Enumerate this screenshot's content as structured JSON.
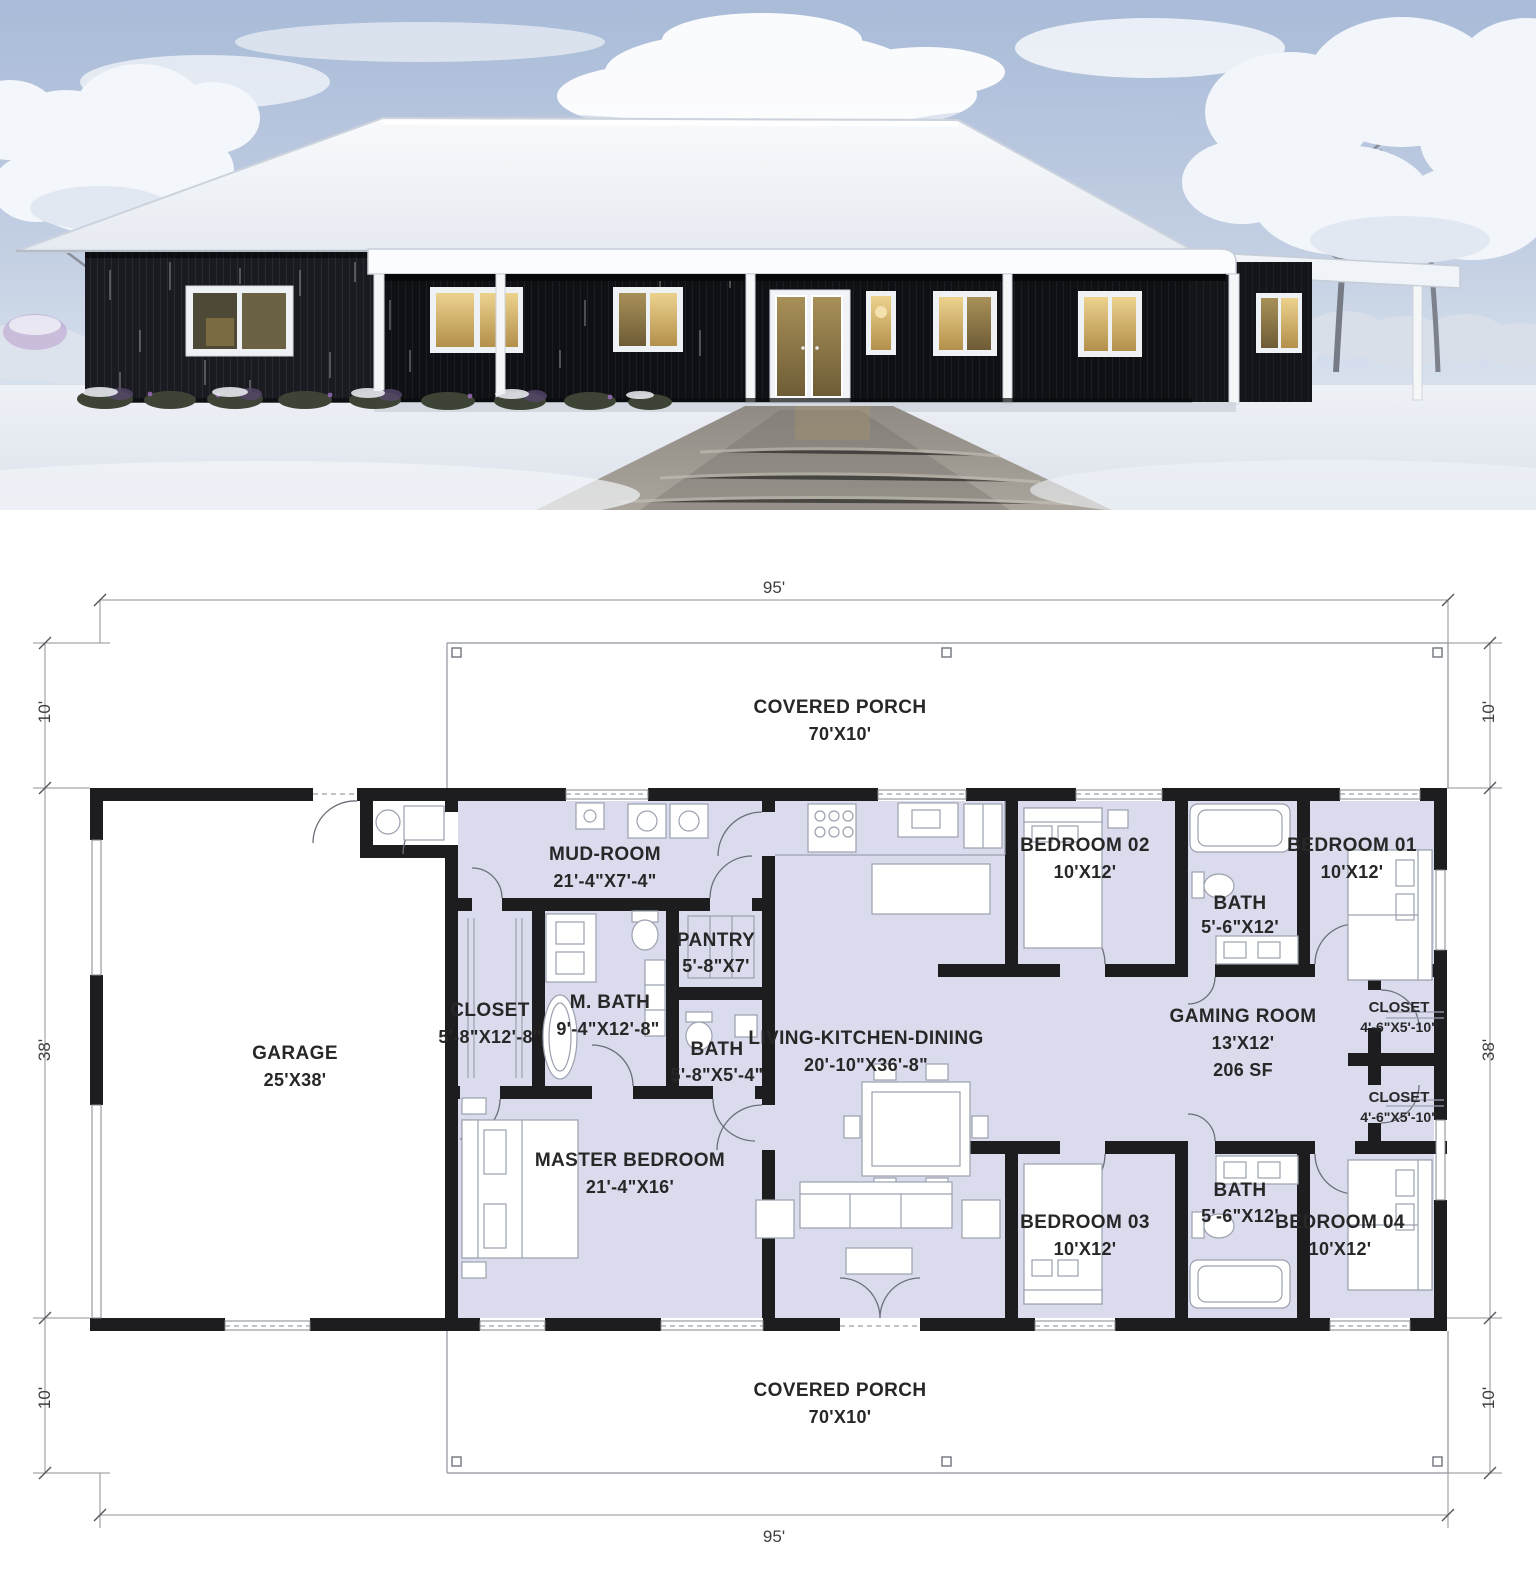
{
  "photo": {
    "colors": {
      "siding": "#141519",
      "roof_snow": "#f4f6f9",
      "sky": "#b7c5dc",
      "window_glow": "#d8b56a",
      "snow_ground": "#e9edf2"
    }
  },
  "floor_plan": {
    "colors": {
      "wall": "#1d1d1f",
      "room_fill": "#dadced",
      "line": "#8e939d"
    },
    "dims": {
      "width_top": "95'",
      "width_bottom": "95'",
      "left": [
        "10'",
        "38'",
        "10'"
      ],
      "right": [
        "10'",
        "38'",
        "10'"
      ]
    },
    "porch_top": {
      "name": "COVERED PORCH",
      "size": "70'X10'"
    },
    "porch_bottom": {
      "name": "COVERED PORCH",
      "size": "70'X10'"
    },
    "rooms": {
      "garage": {
        "name": "GARAGE",
        "size": "25'X38'"
      },
      "mudroom": {
        "name": "MUD-ROOM",
        "size": "21'-4\"X7'-4\""
      },
      "pantry": {
        "name": "PANTRY",
        "size": "5'-8\"X7'"
      },
      "closet": {
        "name": "CLOSET",
        "size": "5'-8\"X12'-8\""
      },
      "master_bath": {
        "name": "M. BATH",
        "size": "9'-4\"X12'-8\""
      },
      "bath_small": {
        "name": "BATH",
        "size": "5'-8\"X5'-4\""
      },
      "master_bedroom": {
        "name": "MASTER BEDROOM",
        "size": "21'-4\"X16'"
      },
      "living": {
        "name": "LIVING-KITCHEN-DINING",
        "size": "20'-10\"X36'-8\""
      },
      "bedroom02": {
        "name": "BEDROOM 02",
        "size": "10'X12'"
      },
      "bath_top": {
        "name": "BATH",
        "size": "5'-6\"X12'"
      },
      "bedroom01": {
        "name": "BEDROOM 01",
        "size": "10'X12'"
      },
      "gaming": {
        "name": "GAMING ROOM",
        "size": "13'X12'",
        "area": "206 SF"
      },
      "closet_upper": {
        "name": "CLOSET",
        "size": "4'-6\"X5'-10\""
      },
      "closet_lower": {
        "name": "CLOSET",
        "size": "4'-6\"X5'-10\""
      },
      "bedroom03": {
        "name": "BEDROOM 03",
        "size": "10'X12'"
      },
      "bath_bottom": {
        "name": "BATH",
        "size": "5'-6\"X12'"
      },
      "bedroom04": {
        "name": "BEDROOM 04",
        "size": "10'X12'"
      }
    }
  }
}
